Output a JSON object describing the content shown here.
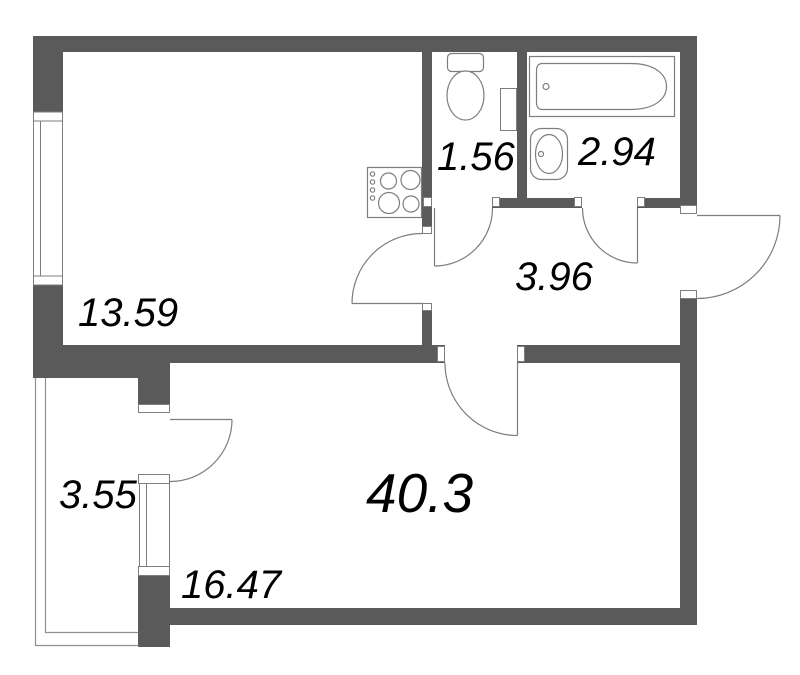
{
  "plan": {
    "type": "apartment-floor-plan",
    "rooms": {
      "kitchen_living": {
        "area": "13.59"
      },
      "wc": {
        "area": "1.56"
      },
      "bathroom": {
        "area": "2.94"
      },
      "hallway": {
        "area": "3.96"
      },
      "balcony": {
        "area": "3.55"
      },
      "living_room": {
        "area": "16.47"
      },
      "total": {
        "area": "40.3"
      }
    },
    "fixtures": [
      "bathtub",
      "sink",
      "toilet",
      "stove",
      "duct"
    ],
    "openings": [
      "entrance-door",
      "kitchen-door",
      "wc-door",
      "bathroom-door",
      "room-door",
      "balcony-door",
      "kitchen-window",
      "balcony-window"
    ],
    "colors": {
      "wall": "#5a5a5a",
      "line": "#7d7d7d",
      "balcony_line": "#909090",
      "text": "#000000",
      "background": "#ffffff"
    }
  }
}
